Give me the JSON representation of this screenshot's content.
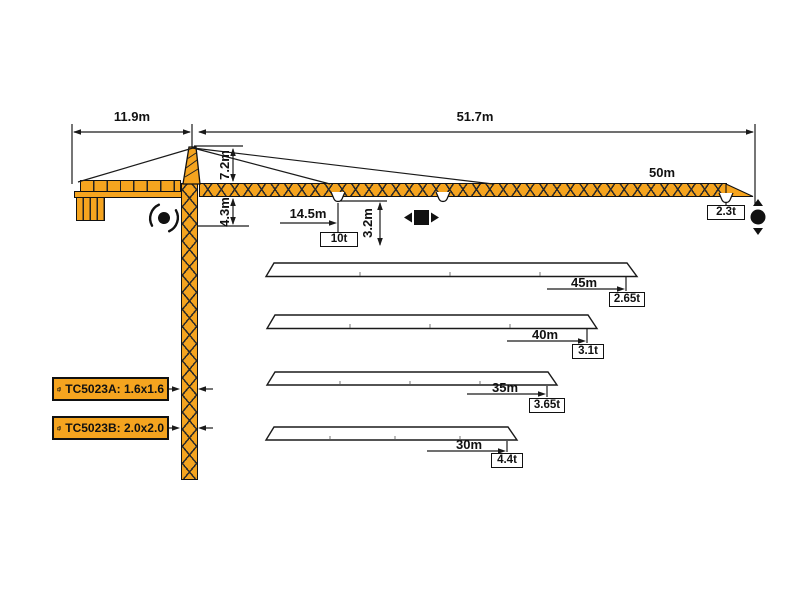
{
  "diagram": {
    "dimensions": {
      "counter_jib_length": "11.9m",
      "working_span": "51.7m",
      "tower_head_height": "7.2m",
      "jib_offset_height": "4.3m",
      "max_load_radius": "14.5m",
      "hook_clearance": "3.2m"
    },
    "main_jib": {
      "length_label": "50m",
      "max_hook_load": "10t",
      "tip_load": "2.3t"
    },
    "variants": [
      {
        "jib_length": "45m",
        "tip_load": "2.65t"
      },
      {
        "jib_length": "40m",
        "tip_load": "3.1t"
      },
      {
        "jib_length": "35m",
        "tip_load": "3.65t"
      },
      {
        "jib_length": "30m",
        "tip_load": "4.4t"
      }
    ],
    "mast_sections": [
      {
        "label": "TC5023A: 1.6x1.6"
      },
      {
        "label": "TC5023B: 2.0x2.0"
      }
    ],
    "icons": {
      "slewing": "rotation-dot-with-arcs",
      "trolley": "square-with-left-right-arrows",
      "hoist": "dot-with-up-down-arrows",
      "mast_section": "section-symbol"
    },
    "colors": {
      "crane_orange": "#F5A41F",
      "line_black": "#1A1A1A",
      "background": "#FFFFFF"
    }
  }
}
